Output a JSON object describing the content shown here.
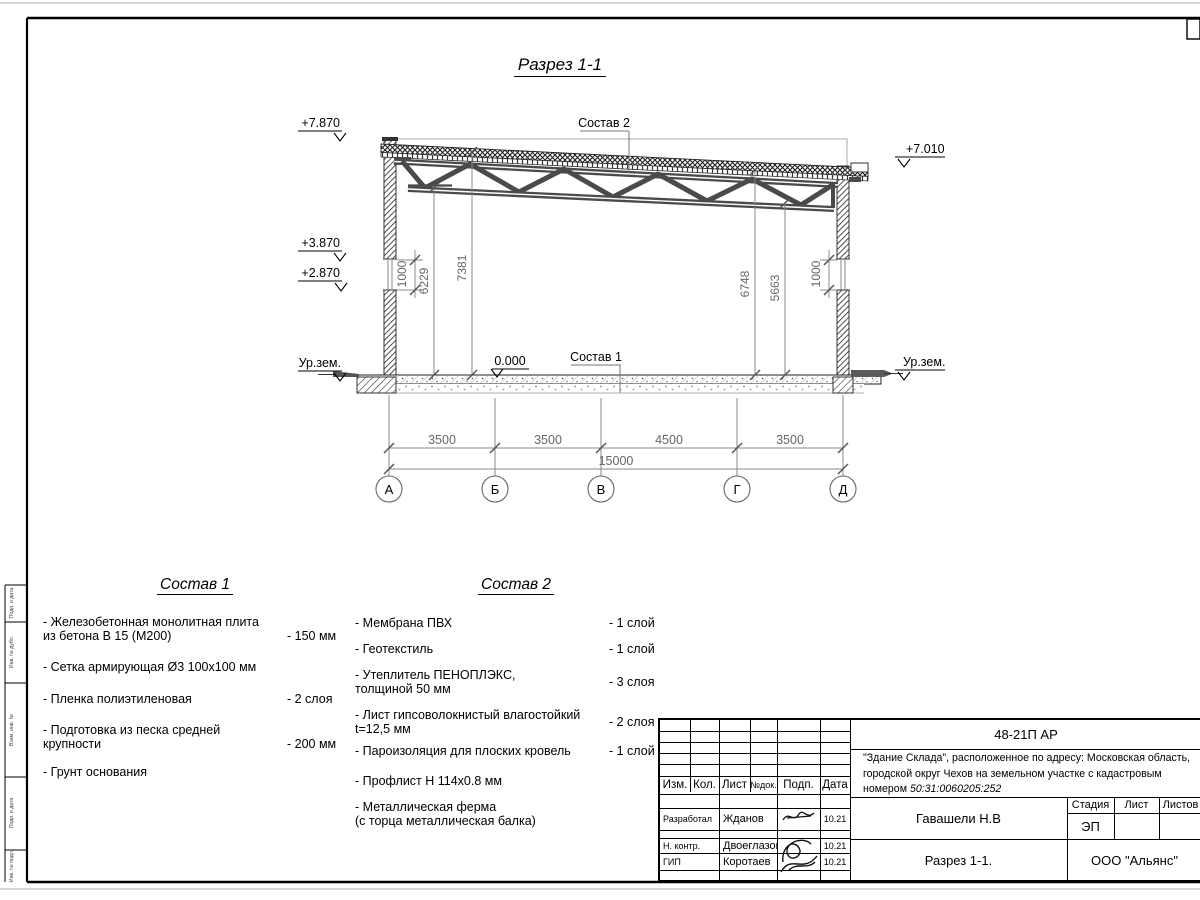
{
  "page": {
    "drawing_title": "Разрез 1-1"
  },
  "section": {
    "callout_top": "Состав 2",
    "callout_floor": "Состав 1",
    "level_zero": "0.000",
    "levels_left": [
      "+7.870",
      "+3.870",
      "+2.870"
    ],
    "ground_left": "Ур.зем.",
    "level_right": "+7.010",
    "ground_right": "Ур.зем.",
    "dims_vertical": [
      "1000",
      "6229",
      "7381",
      "6748",
      "5663",
      "1000"
    ],
    "dims_bottom": [
      "3500",
      "3500",
      "4500",
      "3500"
    ],
    "dim_total": "15000",
    "axes": [
      "А",
      "Б",
      "В",
      "Г",
      "Д"
    ]
  },
  "sostav1": {
    "title": "Состав 1",
    "items": [
      {
        "name": "- Железобетонная  монолитная плита\nиз бетона В 15 (М200)",
        "value": "- 150 мм"
      },
      {
        "name": "- Сетка армирующая Ø3 100х100 мм",
        "value": ""
      },
      {
        "name": "- Пленка полиэтиленовая",
        "value": "-  2 слоя"
      },
      {
        "name": "- Подготовка из песка средней\nкрупности",
        "value": "- 200 мм"
      },
      {
        "name": "- Грунт основания",
        "value": ""
      }
    ]
  },
  "sostav2": {
    "title": "Состав 2",
    "items": [
      {
        "name": "- Мембрана ПВХ",
        "value": "- 1 слой"
      },
      {
        "name": "- Геотекстиль",
        "value": "- 1 слой"
      },
      {
        "name": "- Утеплитель ПЕНОПЛЭКС,\nтолщиной 50 мм",
        "value": "- 3 слоя"
      },
      {
        "name": "- Лист гипсоволокнистый влагостойкий\nt=12,5 мм",
        "value": "- 2 слоя"
      },
      {
        "name": "- Пароизоляция для плоских кровель",
        "value": "- 1 слой"
      },
      {
        "name": "- Профлист Н 114х0.8 мм",
        "value": ""
      },
      {
        "name": "- Металлическая ферма\n(с торца металлическая балка)",
        "value": ""
      }
    ]
  },
  "titleblock": {
    "doc_code": "48-21П АР",
    "description_line1": "\"Здание Склада\", расположенное по адресу: Московская область,",
    "description_line2": "городской округ Чехов на земельном участке с кадастровым",
    "description_line3_prefix": "номером ",
    "description_line3_number": "50:31:0060205:252",
    "columns": {
      "izm": "Изм.",
      "kol": "Кол.",
      "list": "Лист",
      "ndoc": "№док.",
      "podp": "Подп.",
      "data": "Дата"
    },
    "rows": [
      {
        "role": "Разработал",
        "name": "Жданов",
        "date": "10.21"
      },
      {
        "role": "Н. контр.",
        "name": "Двоеглазов",
        "date": "10.21"
      },
      {
        "role": "ГИП",
        "name": "Коротаев",
        "date": "10.21"
      }
    ],
    "author": "Гавашели Н.В",
    "stage_label": "Стадия",
    "sheet_label": "Лист",
    "sheets_label": "Листов",
    "stage_value": "ЭП",
    "drawing_name": "Разрез 1-1.",
    "company": "ООО \"Альянс\""
  },
  "frame": {
    "side_labels": [
      "Подп. и дата",
      "Инв. № дубл.",
      "Взам. инв. №",
      "Подп. и дата",
      "Инв. № подл."
    ]
  }
}
